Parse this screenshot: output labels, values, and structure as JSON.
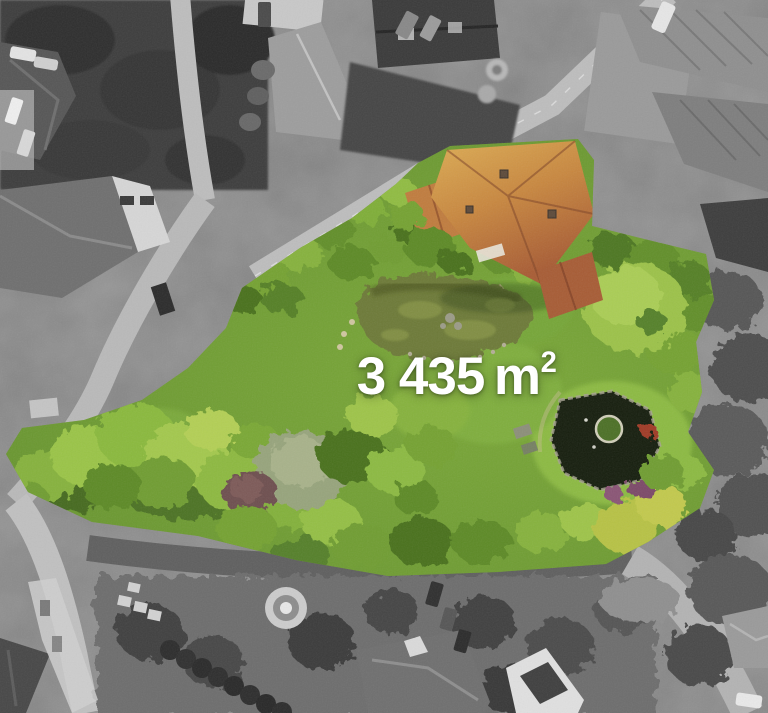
{
  "overlay": {
    "area_value": "3 435",
    "area_unit": "m",
    "area_exponent": "2"
  },
  "photo": {
    "subject": "aerial-view-of-highlighted-property-plot",
    "colors": {
      "label": "#ffffff",
      "grass": "#6f9c33",
      "grass_bright": "#8cba42",
      "canopy_dark": "#3a611e",
      "canopy_bright": "#9cc24a",
      "pond_left": "#6d7a39",
      "pond_right": "#161e0e",
      "roof_main_light": "#d7a54e",
      "roof_main_dark": "#a85c34",
      "roof_wing": "#c07c3e",
      "roof_lower": "#a75c35",
      "road": "#b5b5b5",
      "asphalt": "#646464",
      "mono_trees": "#3c3c3c"
    }
  }
}
